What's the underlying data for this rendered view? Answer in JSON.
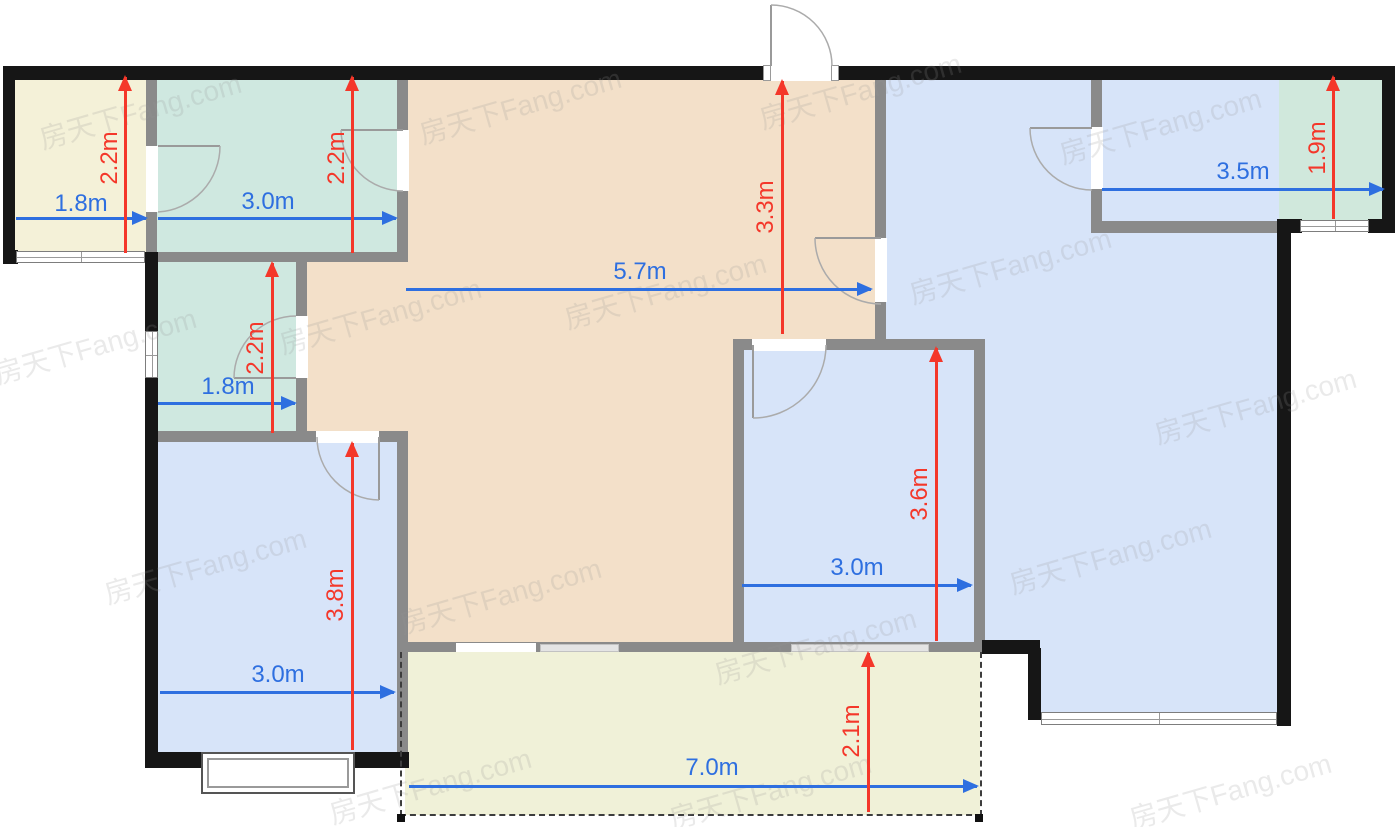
{
  "plan_title": "apartment-floor-plan",
  "room_colors": {
    "cream": "#f4f1d8",
    "teal": "#cfe8e0",
    "green": "#d0e8dc",
    "tan": "#f3e0c9",
    "blue": "#d7e4f9",
    "balcony": "#f0f1d8"
  },
  "dim_colors": {
    "blue": "#2e6fe0",
    "red": "#f4372a"
  },
  "dimensions": {
    "horizontal": [
      {
        "label": "1.8m",
        "x1": 16,
        "x2": 146,
        "y": 218,
        "cx": 81,
        "cy": 204
      },
      {
        "label": "3.0m",
        "x1": 158,
        "x2": 396,
        "y": 218,
        "cx": 268,
        "cy": 202
      },
      {
        "label": "5.7m",
        "x1": 406,
        "x2": 871,
        "y": 289,
        "cx": 640,
        "cy": 272
      },
      {
        "label": "3.5m",
        "x1": 1102,
        "x2": 1383,
        "y": 189,
        "cx": 1243,
        "cy": 172
      },
      {
        "label": "1.8m",
        "x1": 158,
        "x2": 295,
        "y": 403,
        "cx": 228,
        "cy": 387
      },
      {
        "label": "3.0m",
        "x1": 160,
        "x2": 394,
        "y": 692,
        "cx": 278,
        "cy": 675
      },
      {
        "label": "3.0m",
        "x1": 742,
        "x2": 971,
        "y": 585,
        "cx": 857,
        "cy": 568
      },
      {
        "label": "7.0m",
        "x1": 409,
        "x2": 977,
        "y": 786,
        "cx": 712,
        "cy": 768
      }
    ],
    "vertical": [
      {
        "label": "2.2m",
        "x": 125,
        "y1": 77,
        "y2": 253,
        "cx": 110,
        "cy": 158
      },
      {
        "label": "2.2m",
        "x": 352,
        "y1": 77,
        "y2": 253,
        "cx": 337,
        "cy": 158
      },
      {
        "label": "3.3m",
        "x": 782,
        "y1": 81,
        "y2": 334,
        "cx": 766,
        "cy": 207
      },
      {
        "label": "1.9m",
        "x": 1333,
        "y1": 77,
        "y2": 219,
        "cx": 1318,
        "cy": 148
      },
      {
        "label": "2.2m",
        "x": 272,
        "y1": 263,
        "y2": 433,
        "cx": 256,
        "cy": 348
      },
      {
        "label": "3.8m",
        "x": 352,
        "y1": 443,
        "y2": 750,
        "cx": 336,
        "cy": 595
      },
      {
        "label": "3.6m",
        "x": 936,
        "y1": 348,
        "y2": 641,
        "cx": 920,
        "cy": 494
      },
      {
        "label": "2.1m",
        "x": 868,
        "y1": 653,
        "y2": 812,
        "cx": 852,
        "cy": 731
      }
    ]
  },
  "watermark": {
    "text": "房天下Fang.com",
    "positions": [
      [
        140,
        110
      ],
      [
        520,
        105
      ],
      [
        860,
        90
      ],
      [
        1160,
        125
      ],
      [
        95,
        345
      ],
      [
        380,
        315
      ],
      [
        665,
        290
      ],
      [
        1010,
        265
      ],
      [
        1255,
        405
      ],
      [
        205,
        565
      ],
      [
        500,
        595
      ],
      [
        815,
        645
      ],
      [
        1110,
        555
      ],
      [
        430,
        785
      ],
      [
        770,
        790
      ],
      [
        1230,
        790
      ]
    ]
  }
}
